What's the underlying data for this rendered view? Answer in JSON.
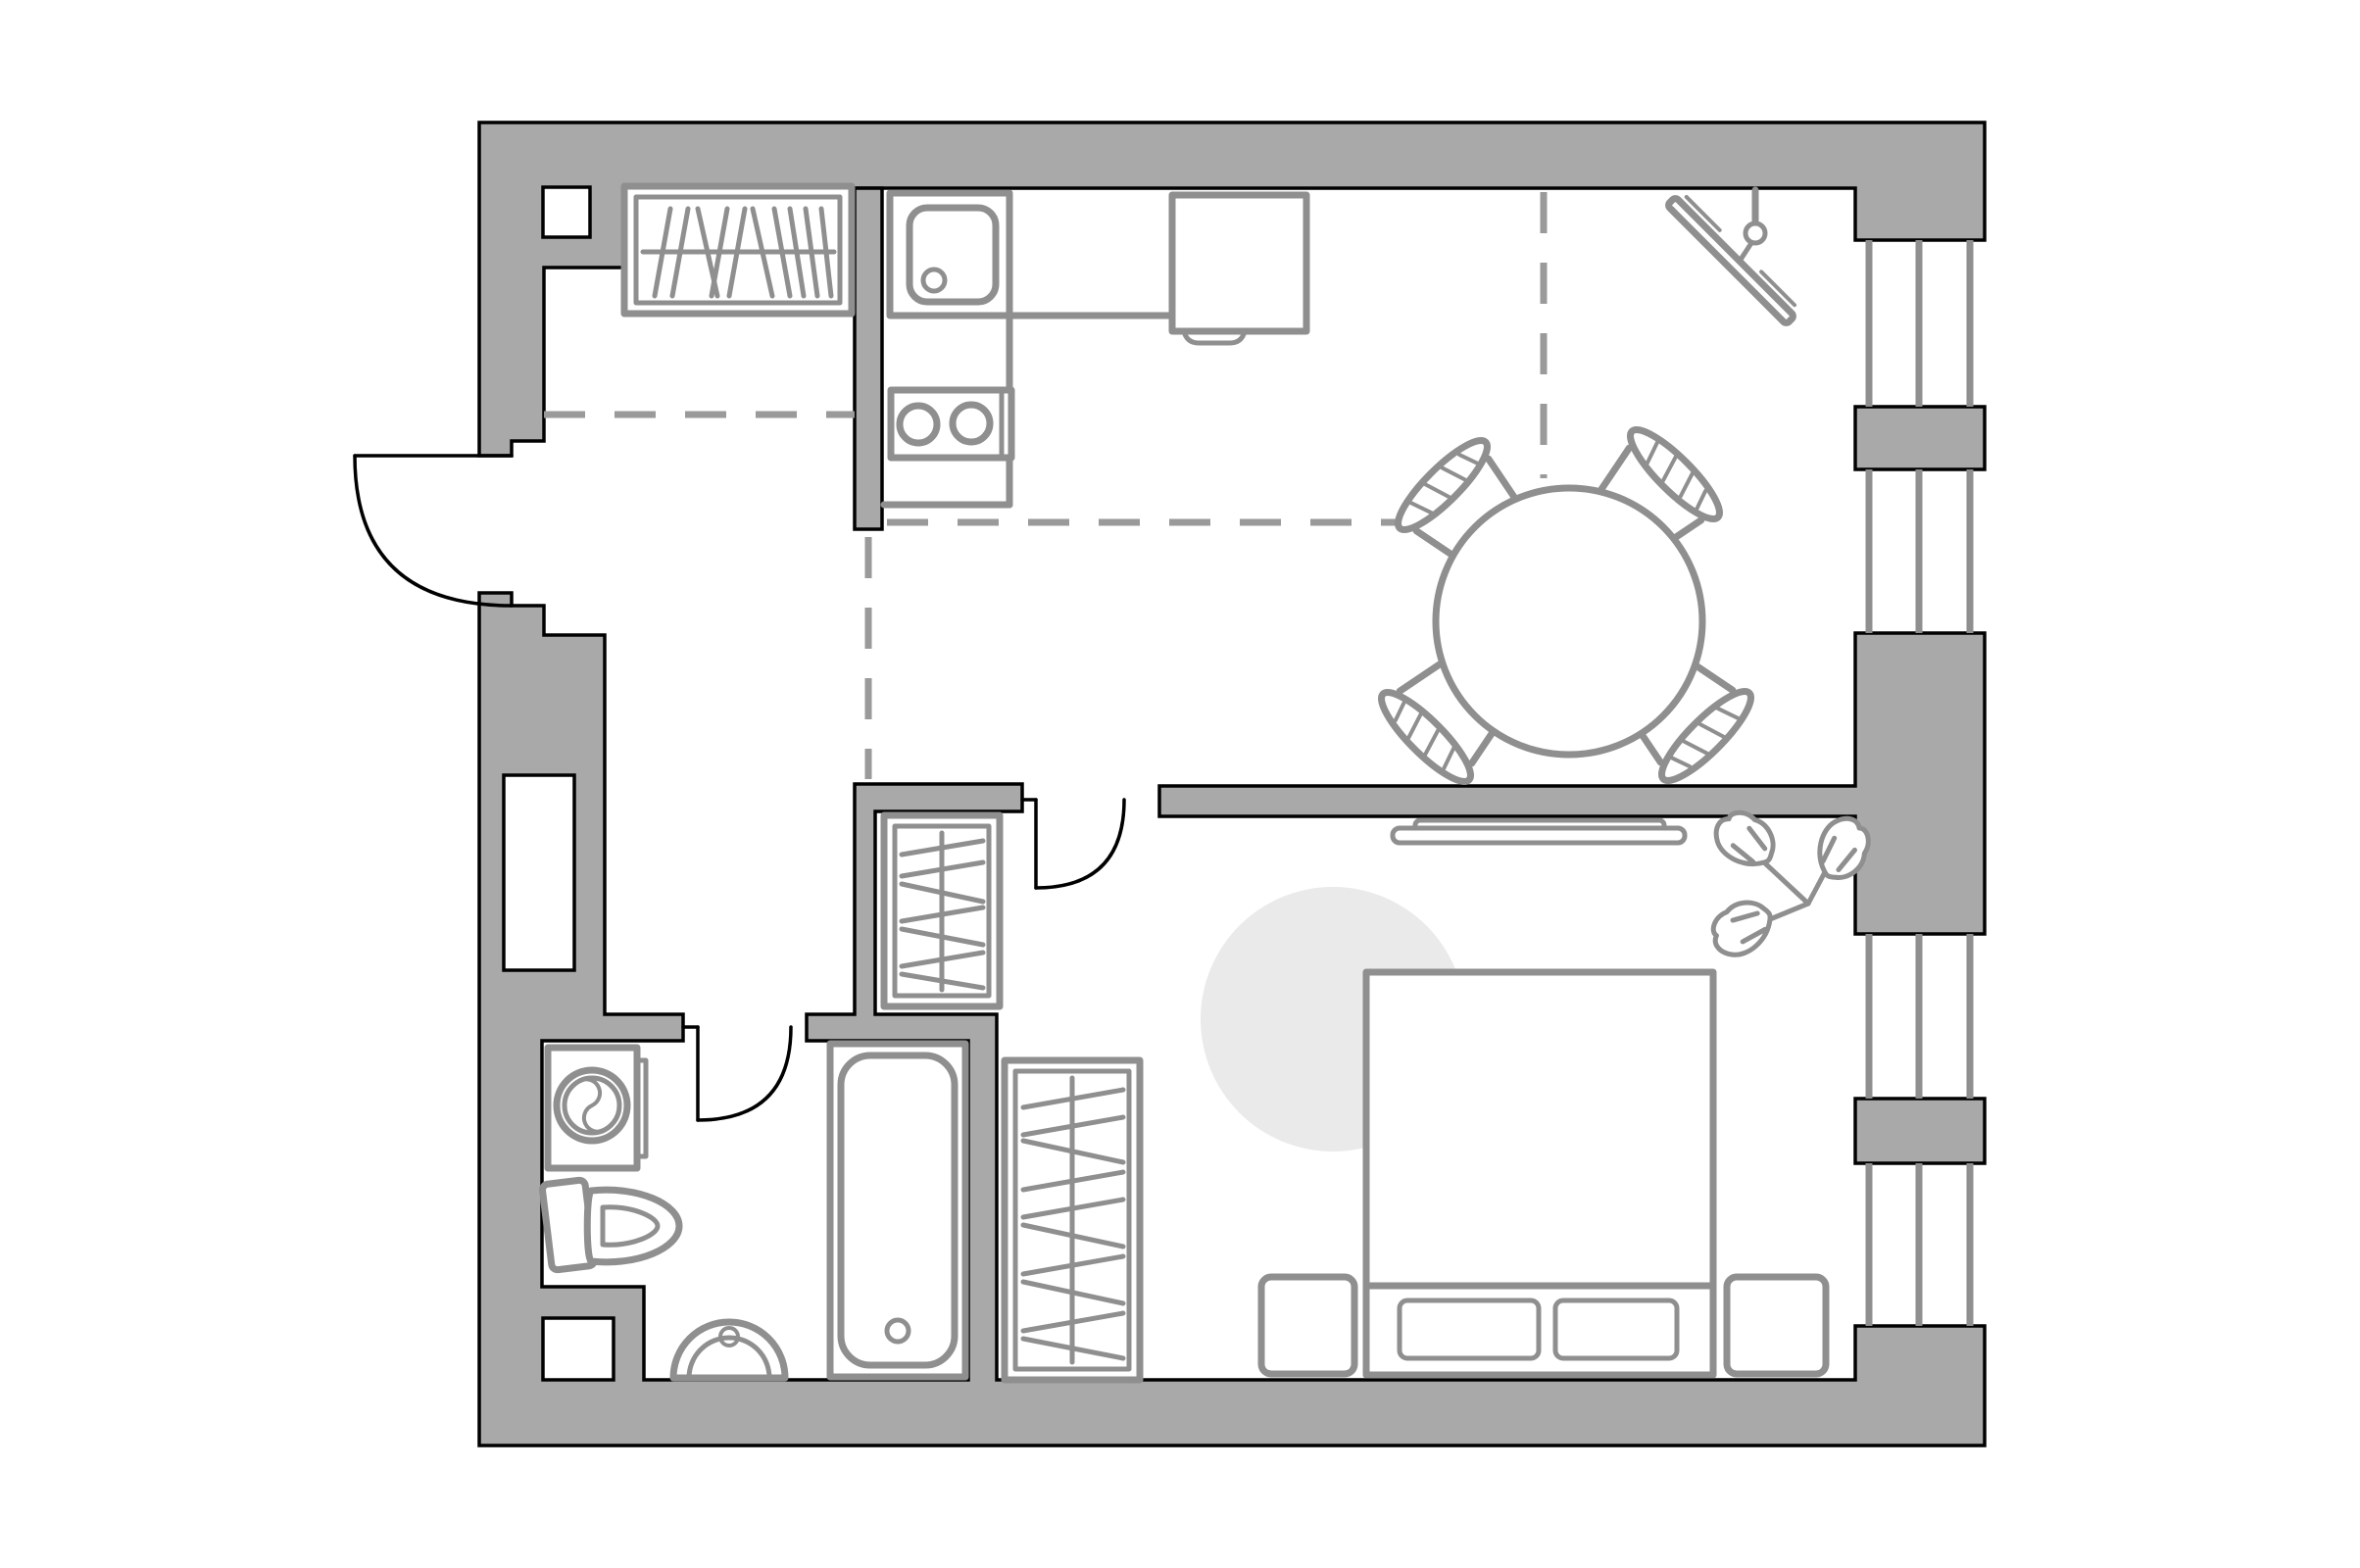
{
  "page": {
    "title": "One-bedroom apartment floor plan",
    "view": "top-down architectural drawing, no text labels",
    "background": "#ffffff"
  },
  "colors": {
    "bg": "#ffffff",
    "wall": "#a9a9a9",
    "ink": "#000000",
    "furn": "#8f8f8f",
    "dash": "#9a9a9a",
    "rug": "#eaeaea"
  },
  "plan": {
    "walls": "thick gray blocks with black outline",
    "windows": [
      {
        "side": "right",
        "bays": 4,
        "panes_per_bay": 3,
        "piers": "gray blocks between bays"
      }
    ],
    "doors": [
      {
        "name": "entry-door",
        "location": "left exterior wall",
        "swing": "outward, quarter arc"
      },
      {
        "name": "bedroom-door",
        "location": "interior partition between hall and bedroom"
      },
      {
        "name": "bathroom-door",
        "location": "bathroom top wall"
      }
    ],
    "zones": [
      {
        "name": "kitchen",
        "items": [
          "kitchen-sink",
          "sink-drain",
          "cooktop-two-burners",
          "counter-run",
          "refrigerator-with-handle"
        ]
      },
      {
        "name": "dining-area",
        "items": [
          "round-dining-table",
          "dining-chair x4",
          "wall-mounted-tv-on-bracket"
        ]
      },
      {
        "name": "entry-hall",
        "items": [
          "entry-wardrobe-with-hangers",
          "hall-wardrobe-with-hangers",
          "zone-boundary-dashed-lines"
        ]
      },
      {
        "name": "bedroom",
        "items": [
          "double-bed",
          "footboard-drawer x2",
          "nightstand x2",
          "round-rug",
          "wall-shelf",
          "monstera-plant",
          "tall-wardrobe-with-hangers"
        ]
      },
      {
        "name": "bathroom",
        "items": [
          "washing-machine",
          "toilet",
          "wall-hung-basin",
          "bathtub"
        ]
      }
    ],
    "niches": [
      "top-left wall niche",
      "left wall shaft niche",
      "bathroom bottom-left shaft niche"
    ],
    "dashed_zone_lines": 4
  }
}
